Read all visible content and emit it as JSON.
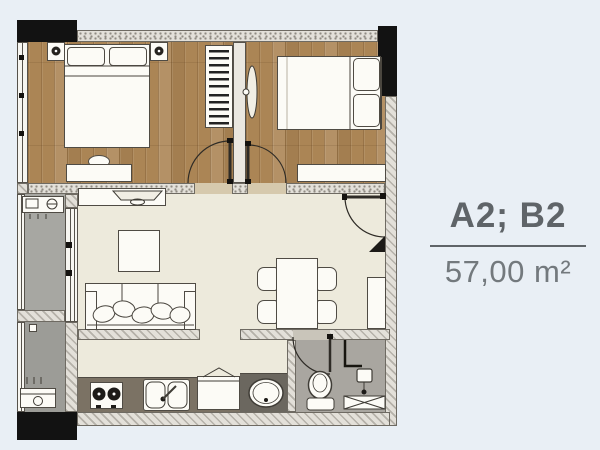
{
  "unit": {
    "title": "A2; B2",
    "area": "57,00 m²"
  },
  "palette": {
    "background": "#e9eff5",
    "wood_floor": "#ab8555",
    "living_floor": "#edeadc",
    "balcony_floor": "#a7a7a2",
    "balcony_floor_2": "#9c9c97",
    "bathroom_floor": "#a9a6a0",
    "counter": "#7b7264",
    "vanity_counter": "#6b675f",
    "column": "#121212",
    "wall_fill": "#e3e0d9",
    "outline": "#4a463f",
    "title_text": "#5f6468",
    "area_text": "#73797d"
  },
  "legend": {
    "rooms": [
      "bedroom-1",
      "bedroom-2",
      "living-room",
      "dining-area",
      "kitchen",
      "bathroom",
      "balcony",
      "laundry-balcony"
    ],
    "items": [
      "double-bed",
      "pillow",
      "wardrobe",
      "nightstand-with-lamp",
      "dressing-table",
      "tv-console",
      "sofa",
      "coffee-table",
      "dining-table",
      "dining-chair",
      "entry-cabinet",
      "stove",
      "kitchen-sink",
      "fridge",
      "wash-basin",
      "toilet",
      "shower",
      "shower-mat",
      "washing-machine",
      "ac-unit",
      "floor-drain",
      "door-swing",
      "window",
      "structural-column"
    ]
  }
}
